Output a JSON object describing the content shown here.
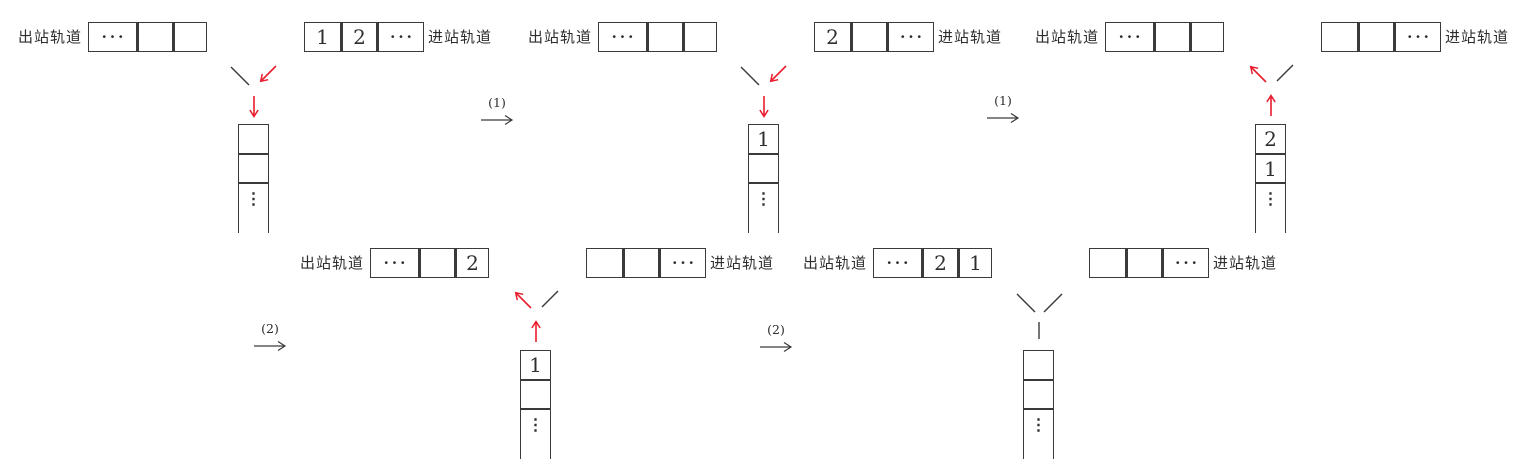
{
  "diagram": {
    "exit_track_label": "出站轨道",
    "entry_track_label": "进站轨道",
    "colors": {
      "line": "#3a3a3a",
      "red": "#ea1c2c"
    },
    "panels": [
      {
        "id": "state-1",
        "junction": "push",
        "exit_cells": [
          "···",
          "",
          ""
        ],
        "entry_cells": [
          "1",
          "2",
          "···"
        ],
        "stack_cells": [
          "",
          "",
          "⋮"
        ]
      },
      {
        "id": "state-2",
        "junction": "push",
        "exit_cells": [
          "···",
          "",
          ""
        ],
        "entry_cells": [
          "2",
          "",
          "···"
        ],
        "stack_cells": [
          "1",
          "",
          "⋮"
        ]
      },
      {
        "id": "state-3",
        "junction": "pop",
        "exit_cells": [
          "···",
          "",
          ""
        ],
        "entry_cells": [
          "",
          "",
          "···"
        ],
        "stack_cells": [
          "2",
          "1",
          "⋮"
        ]
      },
      {
        "id": "state-4",
        "junction": "pop",
        "exit_cells": [
          "···",
          "",
          "2"
        ],
        "entry_cells": [
          "",
          "",
          "···"
        ],
        "stack_cells": [
          "1",
          "",
          "⋮"
        ]
      },
      {
        "id": "state-5",
        "junction": "none",
        "exit_cells": [
          "···",
          "2",
          "1"
        ],
        "entry_cells": [
          "",
          "",
          "···"
        ],
        "stack_cells": [
          "",
          "",
          "⋮"
        ]
      }
    ],
    "steps": [
      {
        "label": "(1)"
      },
      {
        "label": "(1)"
      },
      {
        "label": "(2)"
      },
      {
        "label": "(2)"
      }
    ]
  }
}
